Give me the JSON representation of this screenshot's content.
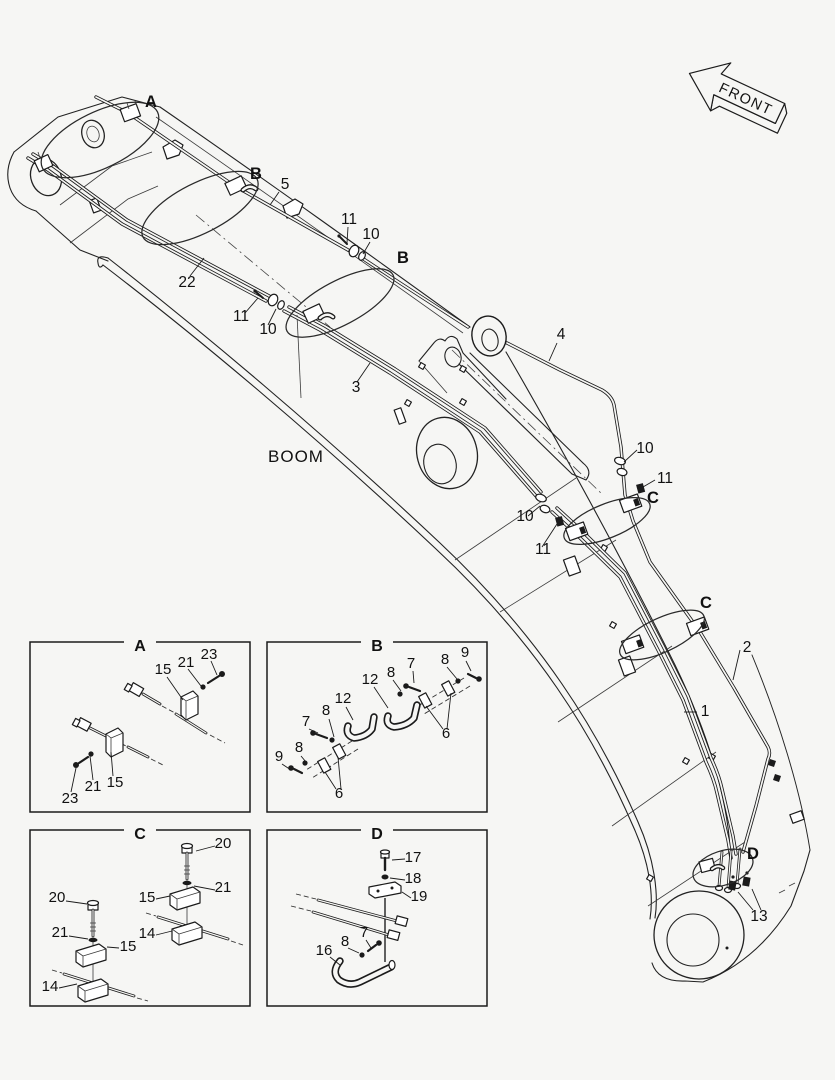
{
  "page": {
    "background_color": "#f6f6f4",
    "line_color": "#1b1b1b"
  },
  "main_diagram": {
    "boom_label": "BOOM",
    "front_label": "FRONT",
    "callouts": {
      "detail_a": "A",
      "detail_b_upper": "B",
      "detail_b_lower": "B",
      "detail_c_upper": "C",
      "detail_c_lower": "C",
      "detail_d": "D",
      "pipe_1": "1",
      "pipe_2": "2",
      "pipe_3": "3",
      "pipe_4": "4",
      "pipe_5": "5",
      "pipe_22": "22",
      "clamp_13": "13",
      "fitting_10_top": "10",
      "fitting_11_top": "11",
      "fitting_10_mid": "10",
      "fitting_11_mid": "11",
      "fitting_10_right": "10",
      "fitting_11_right": "11",
      "fitting_10_lower": "10",
      "fitting_11_lower": "11"
    }
  },
  "detail_boxes": {
    "a": {
      "title": "A",
      "labels": {
        "u15": "15",
        "u21": "21",
        "u23": "23",
        "l23": "23",
        "l21": "21",
        "l15": "15"
      }
    },
    "b": {
      "title": "B",
      "labels": {
        "u12": "12",
        "u8a": "8",
        "u7": "7",
        "u8b": "8",
        "u9": "9",
        "u6": "6",
        "l12": "12",
        "l8a": "8",
        "l7": "7",
        "l8b": "8",
        "l9": "9",
        "l6": "6"
      }
    },
    "c": {
      "title": "C",
      "labels": {
        "r20": "20",
        "r21": "21",
        "r15": "15",
        "r14": "14",
        "l20": "20",
        "l21": "21",
        "l15": "15",
        "l14": "14"
      }
    },
    "d": {
      "title": "D",
      "labels": {
        "n17": "17",
        "n18": "18",
        "n19": "19",
        "n8": "8",
        "n7": "7",
        "n16": "16"
      }
    }
  }
}
